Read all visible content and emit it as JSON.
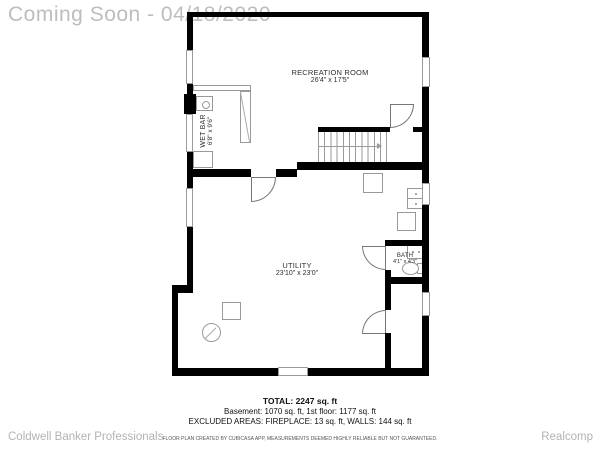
{
  "watermark": "Coming Soon - 04/18/2020",
  "rooms": {
    "recreation": {
      "name": "RECREATION ROOM",
      "dims": "26'4\" x 17'5\""
    },
    "wet_bar": {
      "name": "WET BAR",
      "dims": "6'8\" x 9'6\""
    },
    "utility": {
      "name": "UTILITY",
      "dims": "23'10\" x 23'0\""
    },
    "bath": {
      "name": "BATH",
      "dims": "4'1\" x 4'3\""
    }
  },
  "summary": {
    "total": "TOTAL: 2247 sq. ft",
    "floors": "Basement: 1070 sq. ft, 1st floor: 1177 sq. ft",
    "excluded": "EXCLUDED AREAS: FIREPLACE: 13 sq. ft, WALLS: 144 sq. ft",
    "disclaimer": "FLOOR PLAN CREATED BY CUBICASA APP, MEASUREMENTS DEEMED HIGHLY RELIABLE BUT NOT GUARANTEED."
  },
  "footer": {
    "left": "Coldwell Banker Professionals",
    "right": "Realcomp"
  },
  "colors": {
    "wall": "#000000",
    "fixture_line": "#9a9a9a",
    "watermark": "#bdbdbd",
    "footer": "#b3b3b3"
  }
}
